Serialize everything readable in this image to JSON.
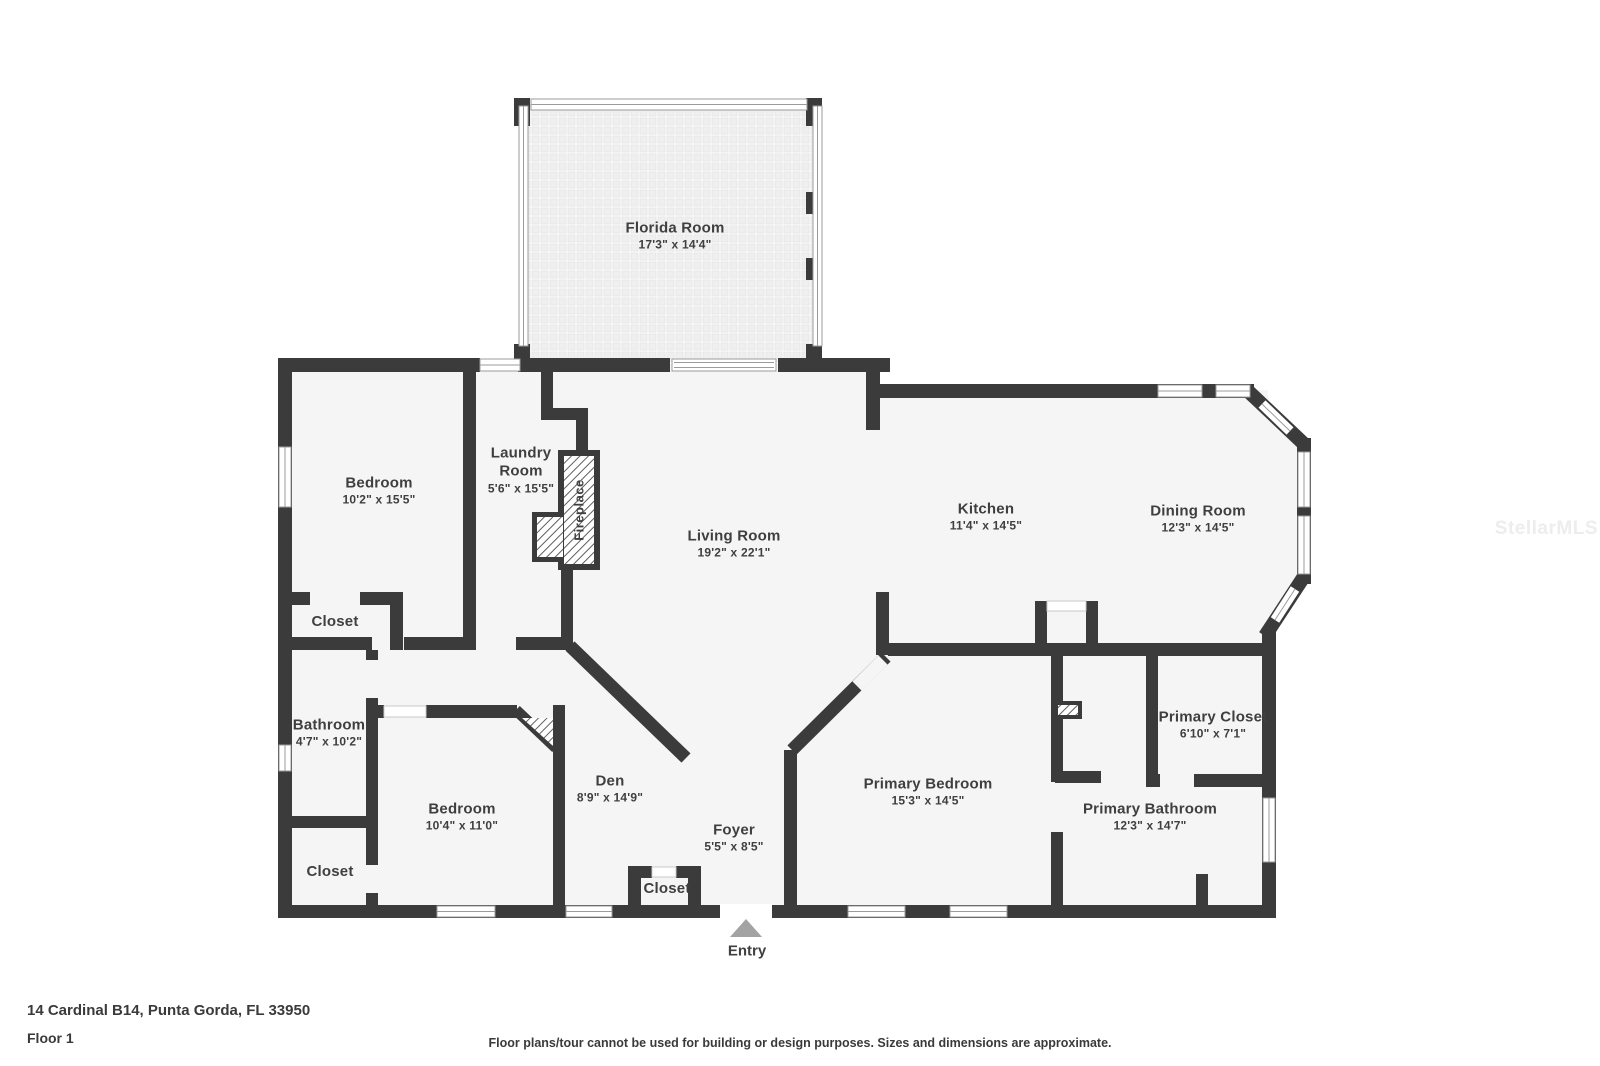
{
  "floorplan": {
    "rooms": [
      {
        "name": "Florida Room",
        "dims": "17'3\" x 14'4\""
      },
      {
        "name": "Bedroom",
        "dims": "10'2\" x 15'5\""
      },
      {
        "name": "Laundry Room",
        "dims": "5'6\" x 15'5\""
      },
      {
        "name": "Living Room",
        "dims": "19'2\" x 22'1\""
      },
      {
        "name": "Kitchen",
        "dims": "11'4\" x 14'5\""
      },
      {
        "name": "Dining Room",
        "dims": "12'3\" x 14'5\""
      },
      {
        "name": "Closet",
        "dims": ""
      },
      {
        "name": "Bathroom",
        "dims": "4'7\" x 10'2\""
      },
      {
        "name": "Bedroom",
        "dims": "10'4\" x 11'0\""
      },
      {
        "name": "Den",
        "dims": "8'9\" x 14'9\""
      },
      {
        "name": "Foyer",
        "dims": "5'5\" x 8'5\""
      },
      {
        "name": "Closet",
        "dims": ""
      },
      {
        "name": "Closet",
        "dims": ""
      },
      {
        "name": "Primary Bedroom",
        "dims": "15'3\" x 14'5\""
      },
      {
        "name": "Primary Closet",
        "dims": "6'10\" x 7'1\""
      },
      {
        "name": "Primary Bathroom",
        "dims": "12'3\" x 14'7\""
      }
    ],
    "fireplace_label": "Fireplace",
    "entry_label": "Entry"
  },
  "footer": {
    "address": "14 Cardinal B14, Punta Gorda, FL 33950",
    "floor": "Floor 1",
    "disclaimer": "Floor plans/tour cannot be used for building or design purposes. Sizes and dimensions are approximate."
  },
  "watermark": "StellarMLS",
  "colors": {
    "wall": "#3b3b3b",
    "floor": "#f5f5f5",
    "label_text": "#3f3f3f",
    "entry_marker": "#a3a3a3",
    "window_line": "#9b9b9b"
  }
}
